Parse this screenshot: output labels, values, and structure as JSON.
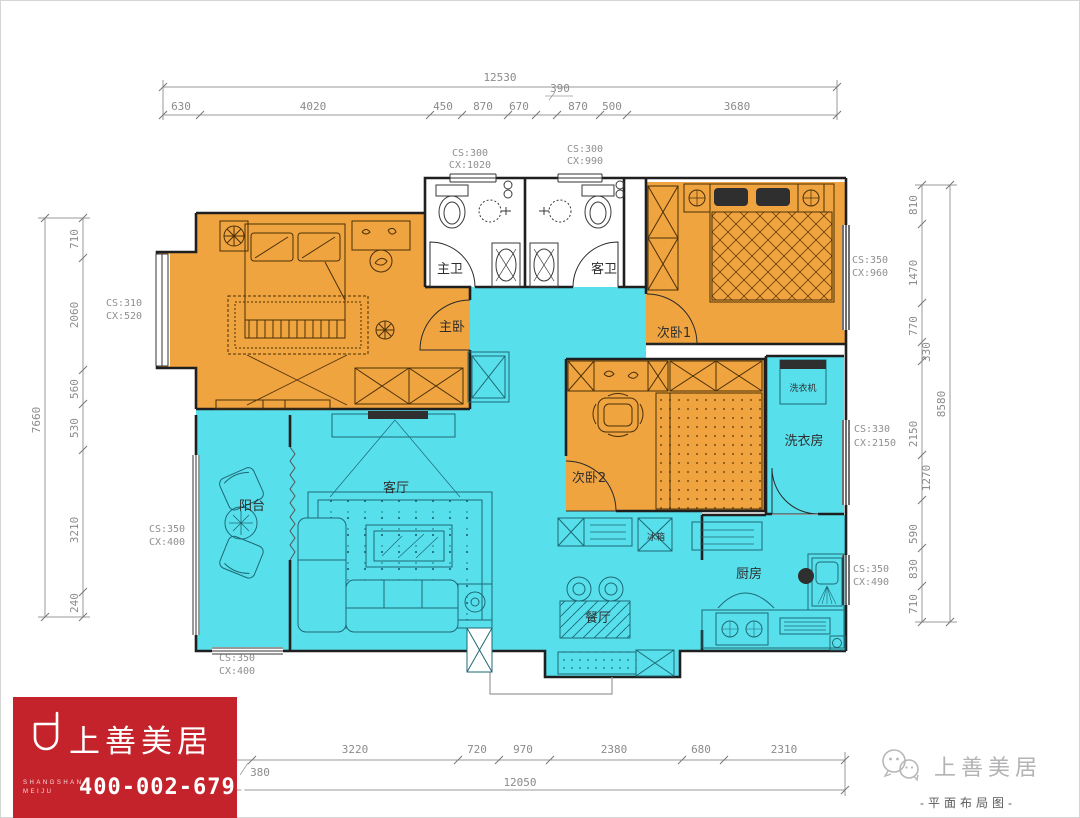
{
  "title": "平面布局图",
  "colors": {
    "orange": "#f0a440",
    "cyan": "#58dfec",
    "red": "#c4232b",
    "wall": "#1f1f1f",
    "dim_gray": "#8b8b8b"
  },
  "dims": {
    "top": {
      "total": "12530",
      "segs": [
        "630",
        "4020",
        "450",
        "870",
        "670",
        "390",
        "870",
        "500",
        "3680"
      ]
    },
    "bottom": {
      "total": "12050",
      "pre": "380",
      "segs": [
        "3220",
        "720",
        "970",
        "2380",
        "680",
        "2310"
      ]
    },
    "left": {
      "total": "7660",
      "segs": [
        "710",
        "2060",
        "560",
        "530",
        "3210",
        "240"
      ]
    },
    "right": {
      "total": "8580",
      "segs": [
        "810",
        "1470",
        "770",
        "330",
        "2150",
        "1270",
        "590",
        "830",
        "710"
      ]
    }
  },
  "windows": {
    "master_bay": [
      "CS:310",
      "CX:520"
    ],
    "master_bath": [
      "CS:300",
      "CX:1020"
    ],
    "guest_bath": [
      "CS:300",
      "CX:990"
    ],
    "bedroom1": [
      "CS:350",
      "CX:960"
    ],
    "laundry": [
      "CS:330",
      "CX:2150"
    ],
    "balcony_side": [
      "CS:350",
      "CX:400"
    ],
    "balcony_bottom": [
      "CS:350",
      "CX:400"
    ],
    "kitchen": [
      "CS:350",
      "CX:490"
    ]
  },
  "rooms": {
    "master_bedroom": "主卧",
    "master_bath": "主卫",
    "guest_bath": "客卫",
    "bedroom1": "次卧1",
    "bedroom2": "次卧2",
    "laundry_room": "洗衣房",
    "washing_machine": "洗衣机",
    "balcony": "阳台",
    "living_room": "客厅",
    "dining_room": "餐厅",
    "kitchen": "厨房",
    "fridge": "冰箱"
  },
  "branding": {
    "logo_cn": "上善美居",
    "logo_en_line1": "SHANGSHAN",
    "logo_en_line2": "MEIJU",
    "phone": "400-002-6791"
  },
  "footer": {
    "brand": "上善美居",
    "caption": "-平面布局图-"
  }
}
